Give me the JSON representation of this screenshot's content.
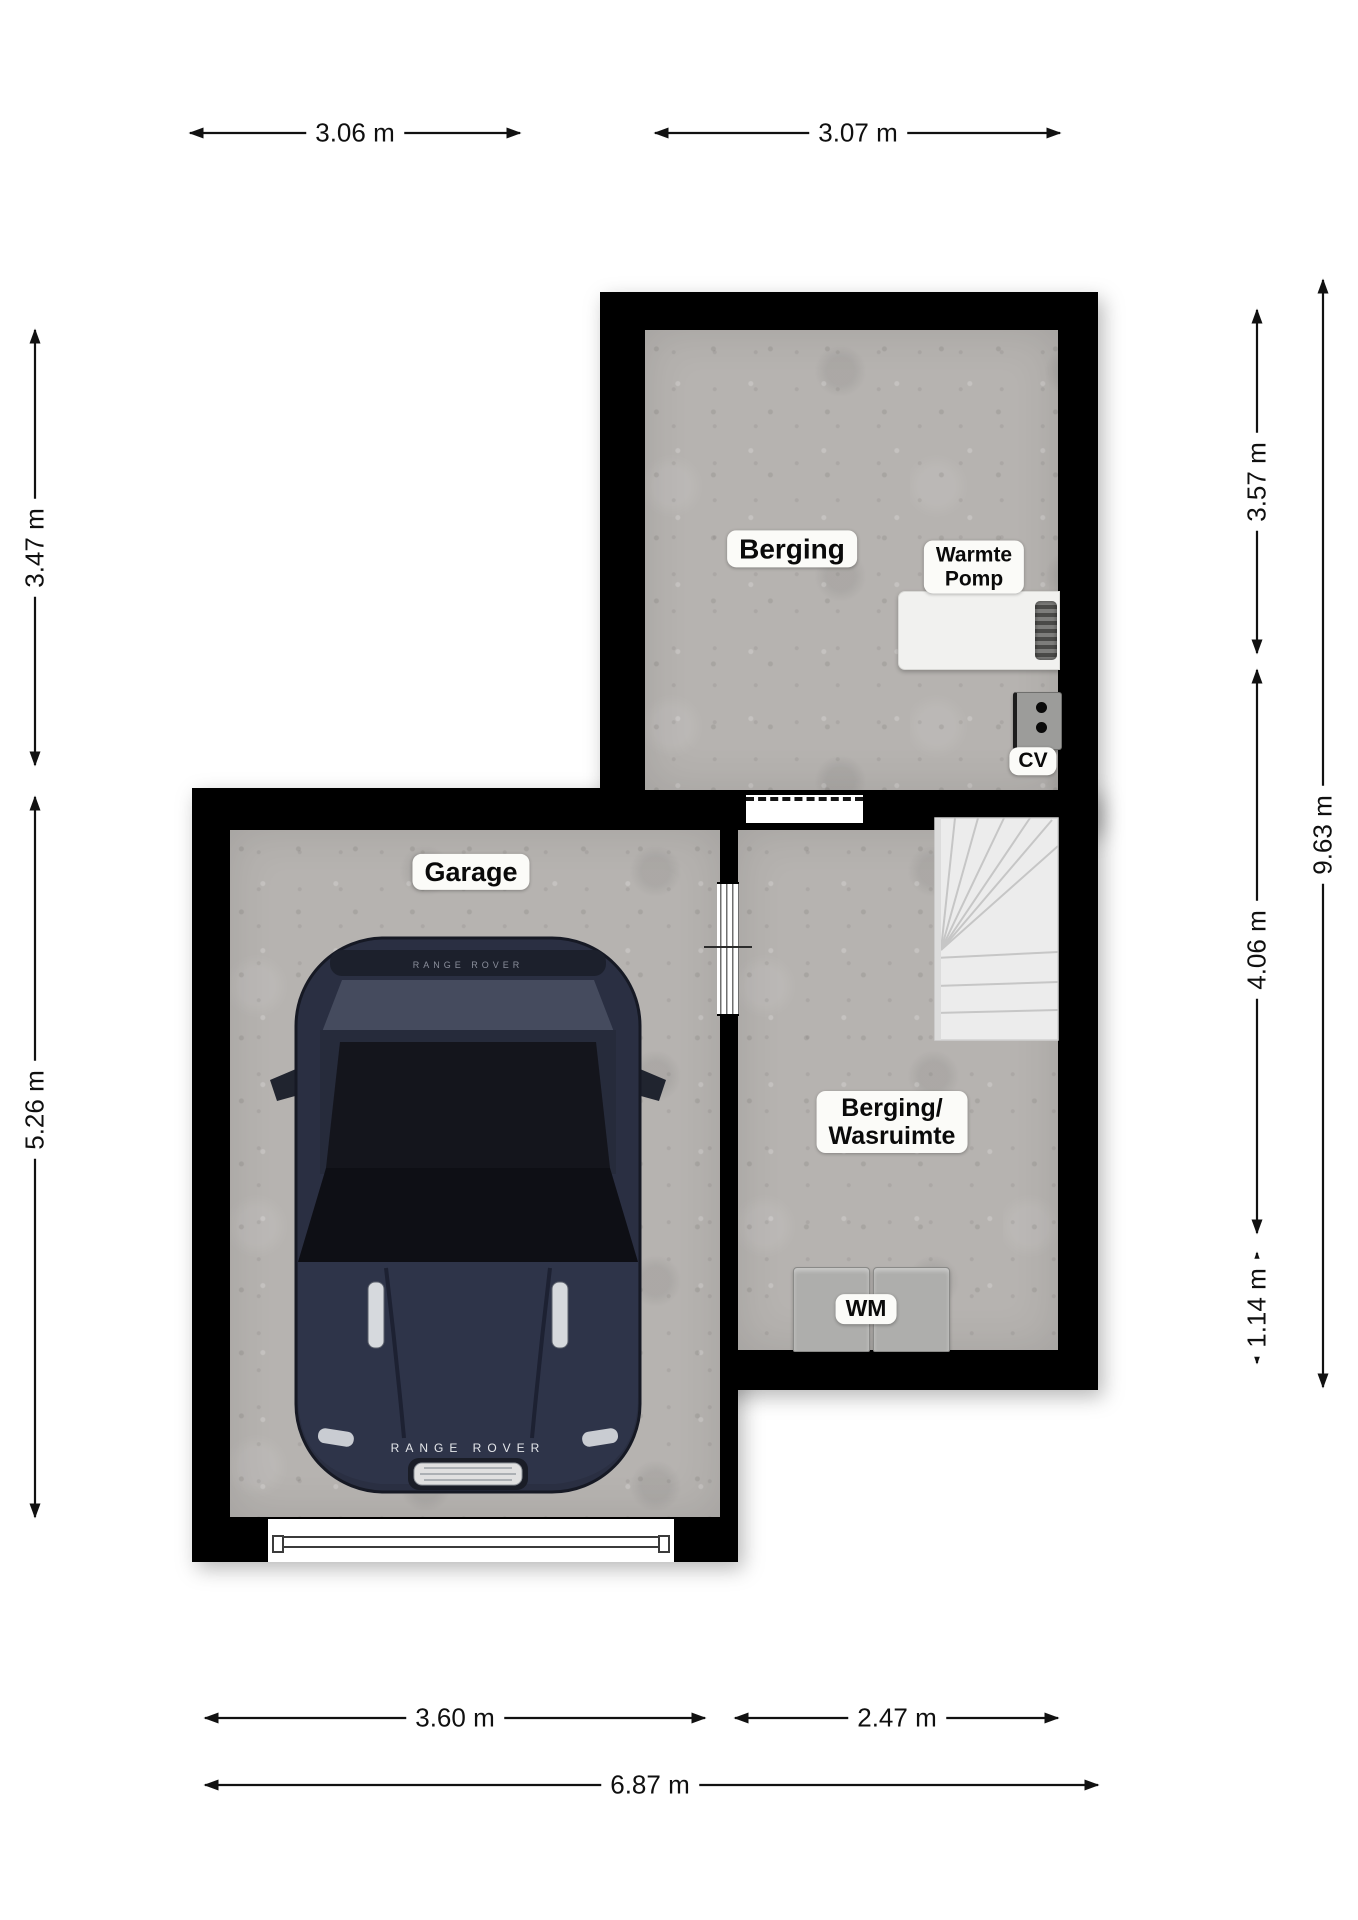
{
  "plan": {
    "rooms": {
      "berging": "Berging",
      "garage": "Garage",
      "berging_wasruimte_line1": "Berging/",
      "berging_wasruimte_line2": "Wasruimte"
    },
    "appliances": {
      "warmte_pomp_line1": "Warmte",
      "warmte_pomp_line2": "Pomp",
      "cv": "CV",
      "wm": "WM"
    },
    "car": {
      "badge": "RANGE ROVER"
    }
  },
  "dimensions": {
    "top1": "3.06 m",
    "top2": "3.07 m",
    "left1": "3.47 m",
    "left2": "5.26 m",
    "right1": "3.57 m",
    "right2": "4.06 m",
    "right3": "1.14 m",
    "right_total": "9.63 m",
    "bottom1": "3.60 m",
    "bottom2": "2.47 m",
    "bottom_total": "6.87 m"
  },
  "colors": {
    "wall": "#000000",
    "floor": "#b6b3b0",
    "stairs": "#ececec",
    "label_background": "#fbfbf8",
    "car_body": "#2a2f42",
    "dimension_line": "#111111"
  }
}
